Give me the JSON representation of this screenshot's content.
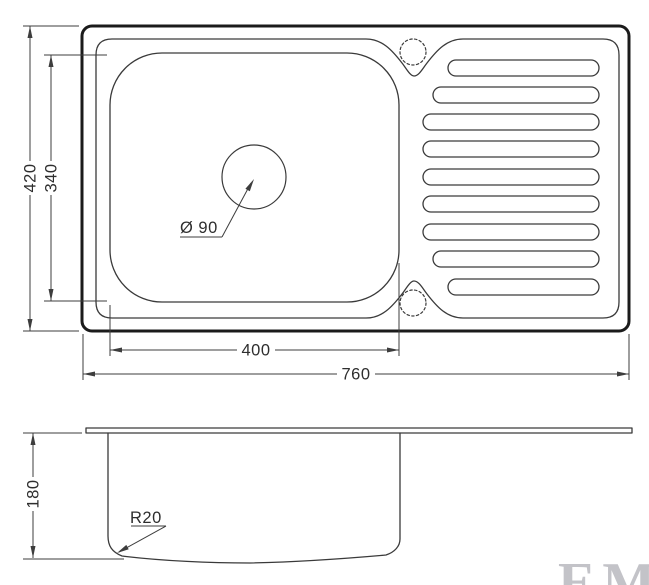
{
  "colors": {
    "background": "#ffffff",
    "outline_strong": "#1b1b1b",
    "outline": "#3a3a3a",
    "dimension": "#3d3d3d",
    "text": "#2e2e2e",
    "watermark": "#c3c3c8"
  },
  "top_view": {
    "overall_width_mm": "760",
    "overall_depth_mm": "420",
    "bowl_width_mm": "400",
    "bowl_depth_mm": "340",
    "drain_diameter_label": "Ø 90"
  },
  "side_view": {
    "bowl_height_mm": "180",
    "corner_radius_label": "R20"
  },
  "watermark_text": "EMA"
}
